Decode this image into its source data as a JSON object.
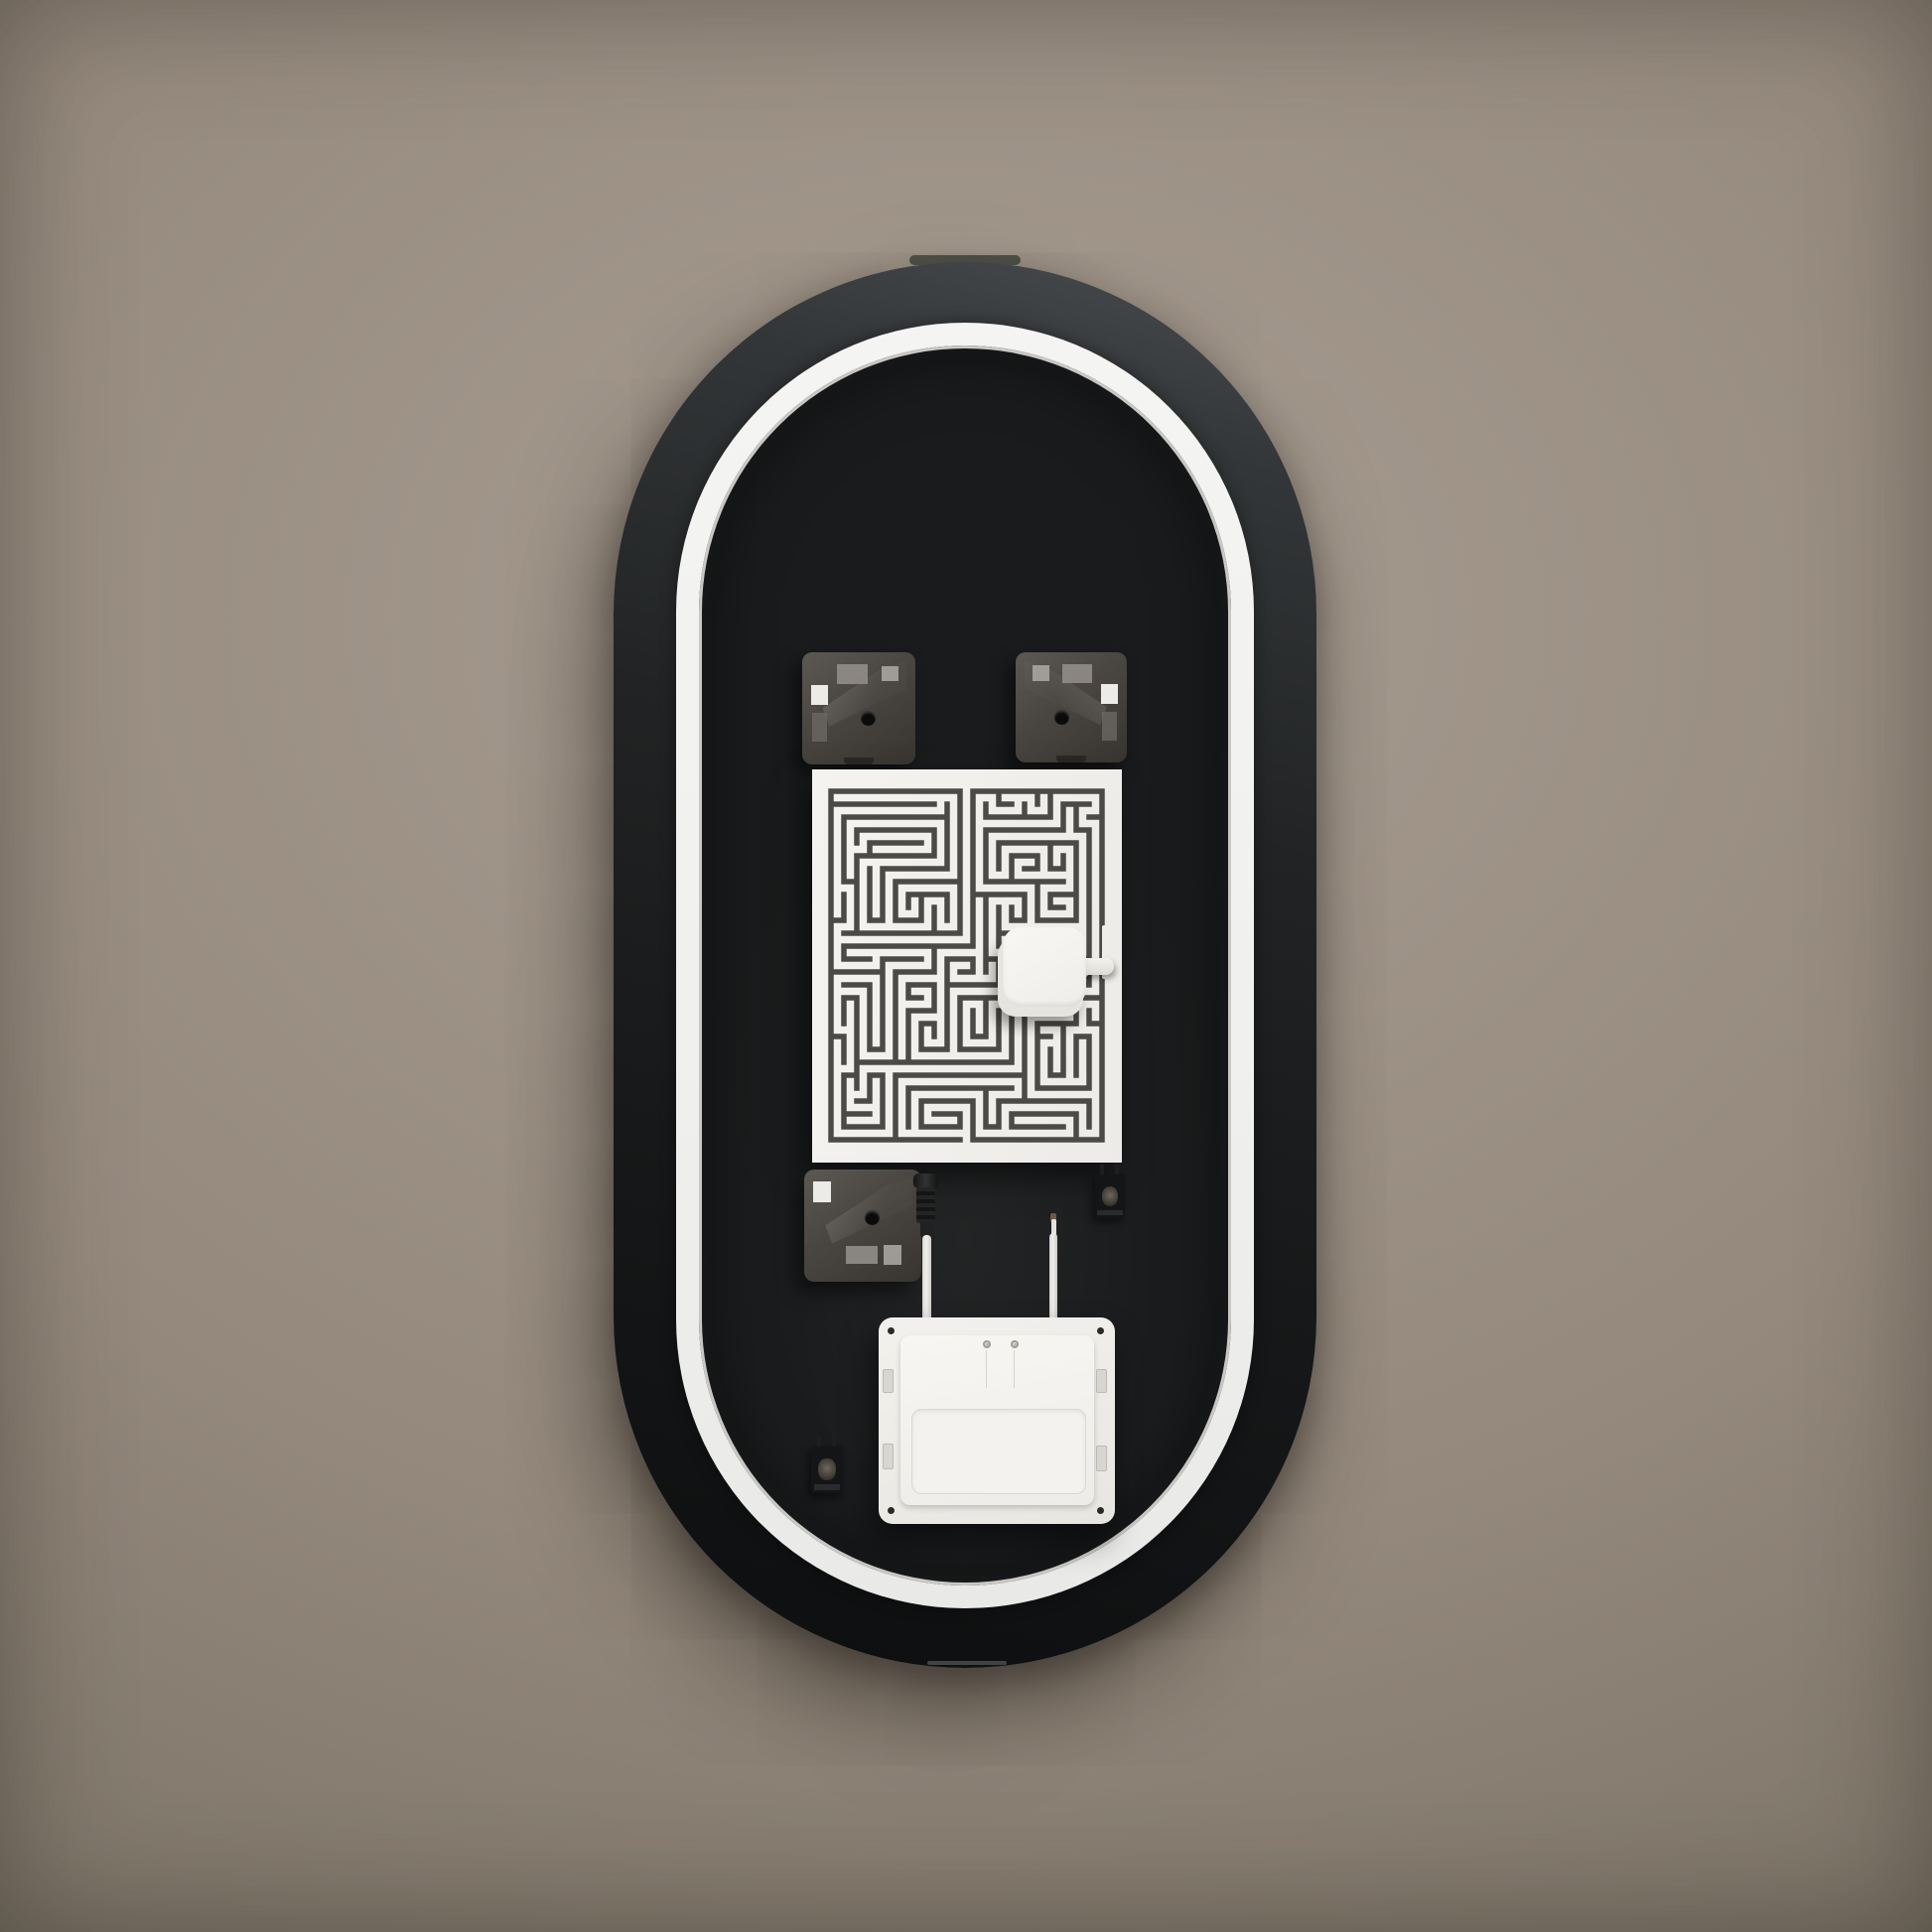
{
  "scene": {
    "description": "Rear view of a wall-mounted pill-shaped backlit LED mirror",
    "wall": "plain plaster wall, warm taupe, soft vignette",
    "visible_text": "none"
  },
  "colors": {
    "wall_center": "#a89d92",
    "wall_mid": "#95897d",
    "wall_deep": "#7d7468",
    "wall_edge": "#6c655c",
    "body_light": "#4a4e50",
    "body_dark": "#0d0e0f",
    "ring": "#f4f4f2",
    "recess": "#1a1c1d",
    "sheet": "#f4f3f0",
    "trace": "#4b4a46",
    "sliver": "#51544b"
  },
  "heater_maze": {
    "cols": 21,
    "rows": 27,
    "cell": 13,
    "margin_x": 19,
    "margin_y": 22,
    "seed": 11,
    "straight_bias": 0.62,
    "stroke_width": 5.5,
    "top_opening_col": 10,
    "bottom_opening_col": 10
  }
}
